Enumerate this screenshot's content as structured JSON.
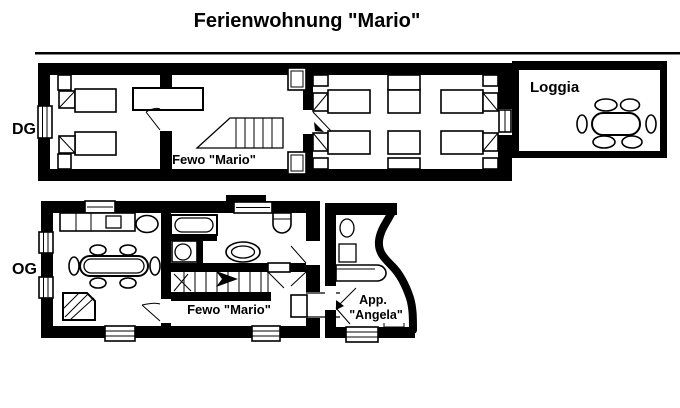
{
  "title": "Ferienwohnung \"Mario\"",
  "floors": {
    "upper": {
      "label": "DG",
      "apartment_label": "Fewo \"Mario\"",
      "loggia_label": "Loggia"
    },
    "lower": {
      "label": "OG",
      "apartment_label": "Fewo \"Mario\"",
      "studio_label_line1": "App.",
      "studio_label_line2": "\"Angela\""
    }
  },
  "colors": {
    "wall": "#000000",
    "background": "#ffffff",
    "text": "#000000"
  }
}
